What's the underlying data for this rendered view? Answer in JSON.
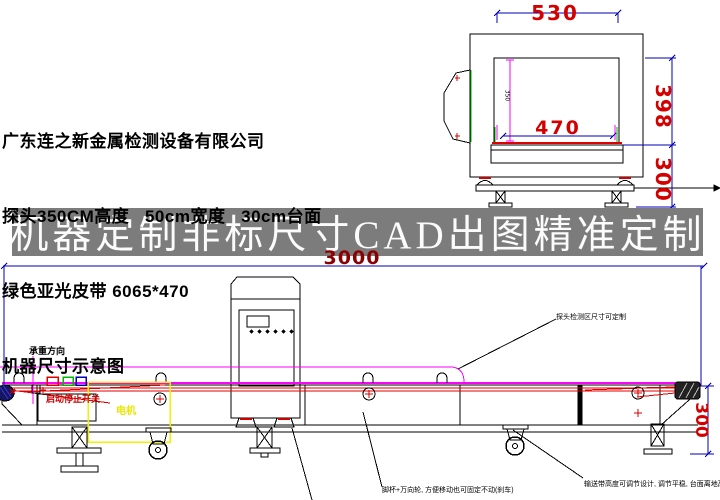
{
  "company_block": {
    "line1": "广东连之新金属检测设备有限公司",
    "line2": "探头350CM高度   50cm宽度   30cm台面",
    "line3": "绿色亚光皮带 6065*470",
    "line4": "机器尺寸示意图"
  },
  "banner": {
    "text": "机器定制非标尺寸CAD出图精准定制"
  },
  "front_view": {
    "dim_outer_width": "530",
    "dim_belt_width": "470",
    "dim_aperture_height": "398",
    "dim_base_height": "300",
    "dim_aperture_inner": "350"
  },
  "side_view": {
    "dim_total_length": "3000",
    "dim_belt_height": "300",
    "label_load_direction": "承重方向",
    "label_start_stop": "启动停止开关",
    "label_motor": "电机",
    "note_detector": "探头检测区尺寸可定制",
    "note_casters": "脚杯+万向轮, 方便移动也可固定不动(刹车)",
    "note_belt_height_text": "输送带高度可调节设计, 调节平稳, 台面离地高度",
    "note_belt_height_value": "300"
  },
  "colors": {
    "dim_red": "#d40000",
    "dim_dark_red": "#8b0000",
    "dim_blue": "#0000b4",
    "magenta": "#ff00ff",
    "green": "#00b400",
    "yellow": "#f0f000",
    "banner_bg": "#7c7c7c"
  }
}
